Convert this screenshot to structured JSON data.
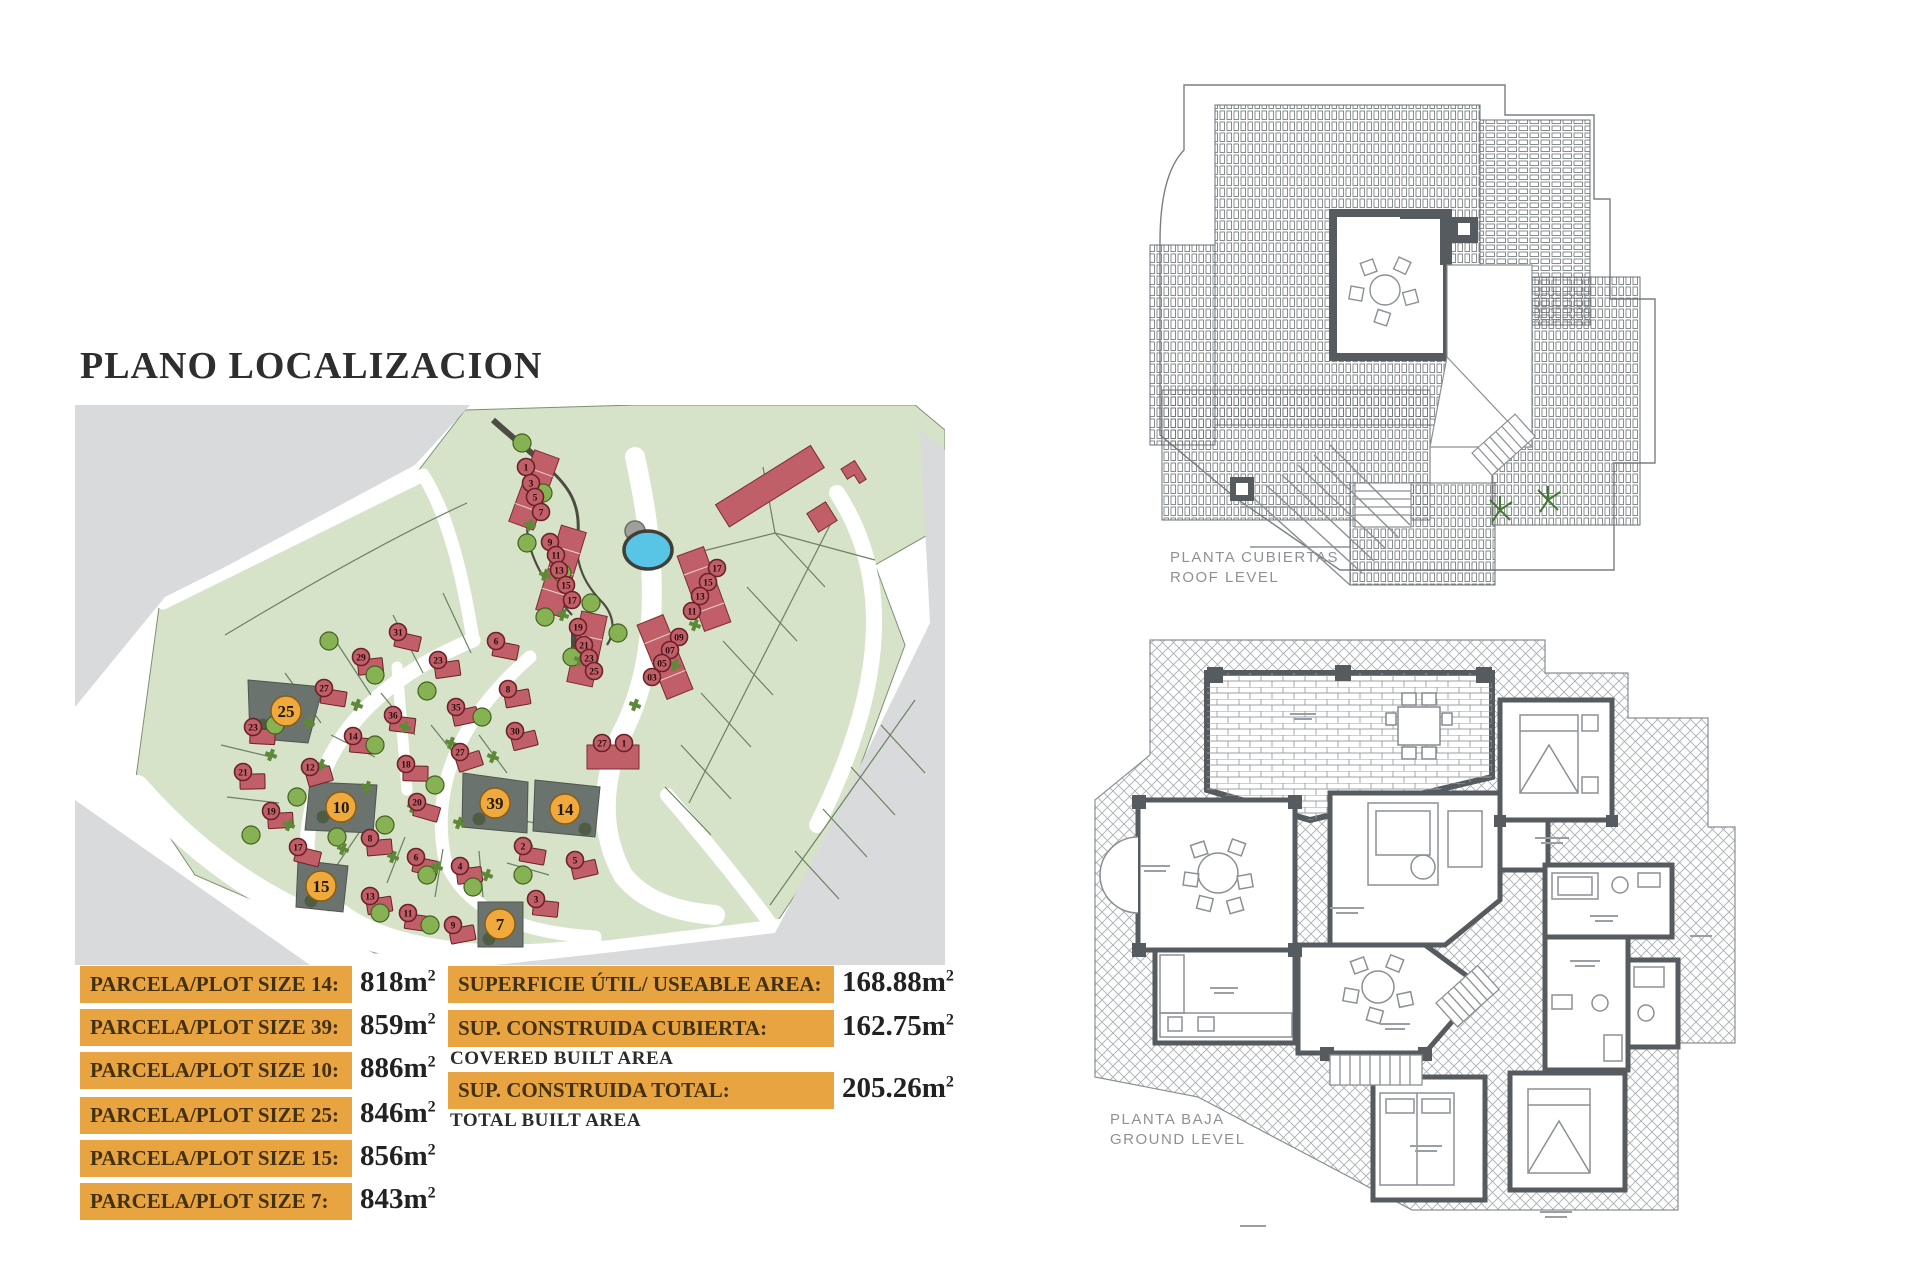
{
  "page": {
    "title": "PLANO LOCALIZACION"
  },
  "units": {
    "base": "m",
    "sup": "2"
  },
  "plot_table": {
    "rows": [
      {
        "label": "PARCELA/PLOT SIZE 14:",
        "value": "818"
      },
      {
        "label": "PARCELA/PLOT SIZE 39:",
        "value": "859"
      },
      {
        "label": "PARCELA/PLOT SIZE 10:",
        "value": "886"
      },
      {
        "label": "PARCELA/PLOT SIZE 25:",
        "value": "846"
      },
      {
        "label": "PARCELA/PLOT SIZE 15:",
        "value": "856"
      },
      {
        "label": "PARCELA/PLOT SIZE 7:",
        "value": "843"
      }
    ]
  },
  "area_table": {
    "rows": [
      {
        "label": "SUPERFICIE ÚTIL/ USEABLE AREA:",
        "value": "168.88",
        "sublabel": ""
      },
      {
        "label": "SUP. CONSTRUIDA CUBIERTA:",
        "value": "162.75",
        "sublabel": "COVERED BUILT AREA"
      },
      {
        "label": "SUP. CONSTRUIDA TOTAL:",
        "value": "205.26",
        "sublabel": "TOTAL BUILT AREA"
      }
    ]
  },
  "floor_plans": {
    "roof": {
      "line1": "PLANTA CUBIERTAS",
      "line2": "ROOF LEVEL"
    },
    "ground": {
      "line1": "PLANTA BAJA",
      "line2": "GROUND LEVEL"
    }
  },
  "site_map": {
    "colors": {
      "green": "#d6e3c9",
      "gray": "#d9dadc",
      "road": "#ffffff",
      "red_fill": "#c05f68",
      "red_stroke": "#6b2128",
      "red_text": "#29090c",
      "plot_gray": "#6b736e",
      "orange_fill": "#f0a93c",
      "orange_stroke": "#8a5c12",
      "orange_text": "#1f1a10",
      "tree_fill": "#86b254",
      "tree_stroke": "#41601f",
      "shrub": "#5e8a38",
      "pond": "#58c5e6",
      "path": "#4c4c42",
      "line": "#6b8161"
    },
    "highlighted_plots": [
      {
        "n": "25",
        "x": 211,
        "y": 306
      },
      {
        "n": "10",
        "x": 266,
        "y": 402
      },
      {
        "n": "39",
        "x": 420,
        "y": 398
      },
      {
        "n": "14",
        "x": 490,
        "y": 404
      },
      {
        "n": "15",
        "x": 246,
        "y": 481
      },
      {
        "n": "7",
        "x": 425,
        "y": 519
      }
    ],
    "red_markers": [
      {
        "n": "1",
        "x": 451,
        "y": 62
      },
      {
        "n": "3",
        "x": 456,
        "y": 78
      },
      {
        "n": "5",
        "x": 460,
        "y": 92
      },
      {
        "n": "7",
        "x": 466,
        "y": 107
      },
      {
        "n": "9",
        "x": 475,
        "y": 137
      },
      {
        "n": "11",
        "x": 481,
        "y": 150
      },
      {
        "n": "13",
        "x": 484,
        "y": 165
      },
      {
        "n": "15",
        "x": 491,
        "y": 180
      },
      {
        "n": "17",
        "x": 497,
        "y": 195
      },
      {
        "n": "19",
        "x": 503,
        "y": 222
      },
      {
        "n": "21",
        "x": 509,
        "y": 240
      },
      {
        "n": "23",
        "x": 514,
        "y": 253
      },
      {
        "n": "25",
        "x": 519,
        "y": 266
      },
      {
        "n": "17",
        "x": 642,
        "y": 163
      },
      {
        "n": "15",
        "x": 633,
        "y": 177
      },
      {
        "n": "13",
        "x": 625,
        "y": 191
      },
      {
        "n": "11",
        "x": 617,
        "y": 206
      },
      {
        "n": "09",
        "x": 604,
        "y": 232
      },
      {
        "n": "07",
        "x": 595,
        "y": 245
      },
      {
        "n": "05",
        "x": 587,
        "y": 258
      },
      {
        "n": "03",
        "x": 577,
        "y": 272
      },
      {
        "n": "27",
        "x": 527,
        "y": 338
      },
      {
        "n": "1",
        "x": 549,
        "y": 338
      },
      {
        "n": "31",
        "x": 323,
        "y": 227,
        "h": 1
      },
      {
        "n": "29",
        "x": 286,
        "y": 252,
        "h": 1
      },
      {
        "n": "6",
        "x": 421,
        "y": 236,
        "h": 1
      },
      {
        "n": "23",
        "x": 363,
        "y": 255,
        "h": 1
      },
      {
        "n": "27",
        "x": 249,
        "y": 283,
        "h": 1
      },
      {
        "n": "8",
        "x": 433,
        "y": 284,
        "h": 1
      },
      {
        "n": "36",
        "x": 318,
        "y": 310,
        "h": 1
      },
      {
        "n": "35",
        "x": 381,
        "y": 302,
        "h": 1
      },
      {
        "n": "14",
        "x": 278,
        "y": 331,
        "h": 1
      },
      {
        "n": "30",
        "x": 440,
        "y": 326,
        "h": 1
      },
      {
        "n": "23",
        "x": 178,
        "y": 322,
        "h": 1
      },
      {
        "n": "12",
        "x": 235,
        "y": 362,
        "h": 1
      },
      {
        "n": "18",
        "x": 331,
        "y": 359,
        "h": 1
      },
      {
        "n": "27",
        "x": 385,
        "y": 347,
        "h": 1
      },
      {
        "n": "21",
        "x": 168,
        "y": 367,
        "h": 1
      },
      {
        "n": "20",
        "x": 342,
        "y": 397,
        "h": 1
      },
      {
        "n": "19",
        "x": 196,
        "y": 406,
        "h": 1
      },
      {
        "n": "17",
        "x": 223,
        "y": 442,
        "h": 1
      },
      {
        "n": "8",
        "x": 295,
        "y": 433,
        "h": 1
      },
      {
        "n": "6",
        "x": 341,
        "y": 452,
        "h": 1
      },
      {
        "n": "4",
        "x": 385,
        "y": 461,
        "h": 1
      },
      {
        "n": "2",
        "x": 448,
        "y": 441,
        "h": 1
      },
      {
        "n": "13",
        "x": 295,
        "y": 491,
        "h": 1
      },
      {
        "n": "11",
        "x": 333,
        "y": 508,
        "h": 1
      },
      {
        "n": "9",
        "x": 378,
        "y": 520,
        "h": 1
      },
      {
        "n": "3",
        "x": 461,
        "y": 494,
        "h": 1
      },
      {
        "n": "5",
        "x": 500,
        "y": 455,
        "h": 1
      }
    ],
    "trees": [
      {
        "x": 447,
        "y": 38
      },
      {
        "x": 468,
        "y": 88
      },
      {
        "x": 452,
        "y": 138
      },
      {
        "x": 487,
        "y": 168
      },
      {
        "x": 516,
        "y": 198
      },
      {
        "x": 543,
        "y": 228
      },
      {
        "x": 470,
        "y": 212
      },
      {
        "x": 497,
        "y": 252
      },
      {
        "x": 254,
        "y": 236
      },
      {
        "x": 300,
        "y": 270
      },
      {
        "x": 352,
        "y": 286
      },
      {
        "x": 407,
        "y": 312
      },
      {
        "x": 300,
        "y": 340
      },
      {
        "x": 360,
        "y": 380
      },
      {
        "x": 310,
        "y": 420
      },
      {
        "x": 262,
        "y": 432
      },
      {
        "x": 352,
        "y": 470
      },
      {
        "x": 398,
        "y": 482
      },
      {
        "x": 448,
        "y": 470
      },
      {
        "x": 200,
        "y": 320
      },
      {
        "x": 222,
        "y": 392
      },
      {
        "x": 176,
        "y": 430
      },
      {
        "x": 305,
        "y": 508
      },
      {
        "x": 355,
        "y": 520
      }
    ],
    "shrubs": [
      {
        "x": 234,
        "y": 318
      },
      {
        "x": 282,
        "y": 300
      },
      {
        "x": 330,
        "y": 322
      },
      {
        "x": 376,
        "y": 338
      },
      {
        "x": 418,
        "y": 352
      },
      {
        "x": 196,
        "y": 350
      },
      {
        "x": 246,
        "y": 360
      },
      {
        "x": 292,
        "y": 382
      },
      {
        "x": 338,
        "y": 402
      },
      {
        "x": 384,
        "y": 418
      },
      {
        "x": 214,
        "y": 420
      },
      {
        "x": 268,
        "y": 444
      },
      {
        "x": 318,
        "y": 452
      },
      {
        "x": 362,
        "y": 462
      },
      {
        "x": 412,
        "y": 470
      },
      {
        "x": 452,
        "y": 440
      },
      {
        "x": 455,
        "y": 120
      },
      {
        "x": 470,
        "y": 170
      },
      {
        "x": 488,
        "y": 210
      },
      {
        "x": 505,
        "y": 255
      },
      {
        "x": 620,
        "y": 220
      },
      {
        "x": 600,
        "y": 260
      },
      {
        "x": 560,
        "y": 300
      }
    ]
  }
}
